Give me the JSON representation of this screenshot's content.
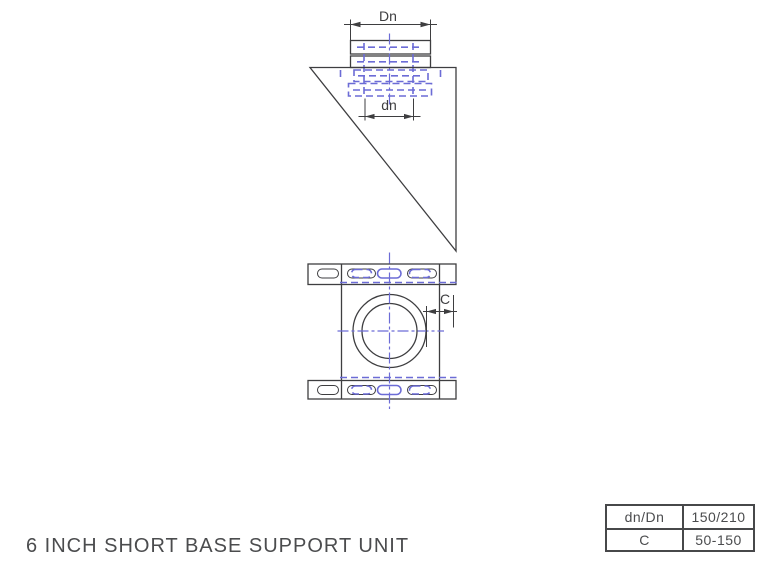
{
  "title": "6 INCH SHORT BASE SUPPORT UNIT",
  "drawing": {
    "labels": {
      "outer_diameter": "Dn",
      "inner_diameter": "dn",
      "edge_distance": "C"
    }
  },
  "spec_table": {
    "rows": [
      {
        "param": "dn/Dn",
        "value": "150/210"
      },
      {
        "param": "C",
        "value": "50-150"
      }
    ]
  },
  "colors": {
    "line": "#3e3e40",
    "hidden": "#6c6cd6",
    "text": "#4b4c4e",
    "table_border": "#47484a"
  }
}
